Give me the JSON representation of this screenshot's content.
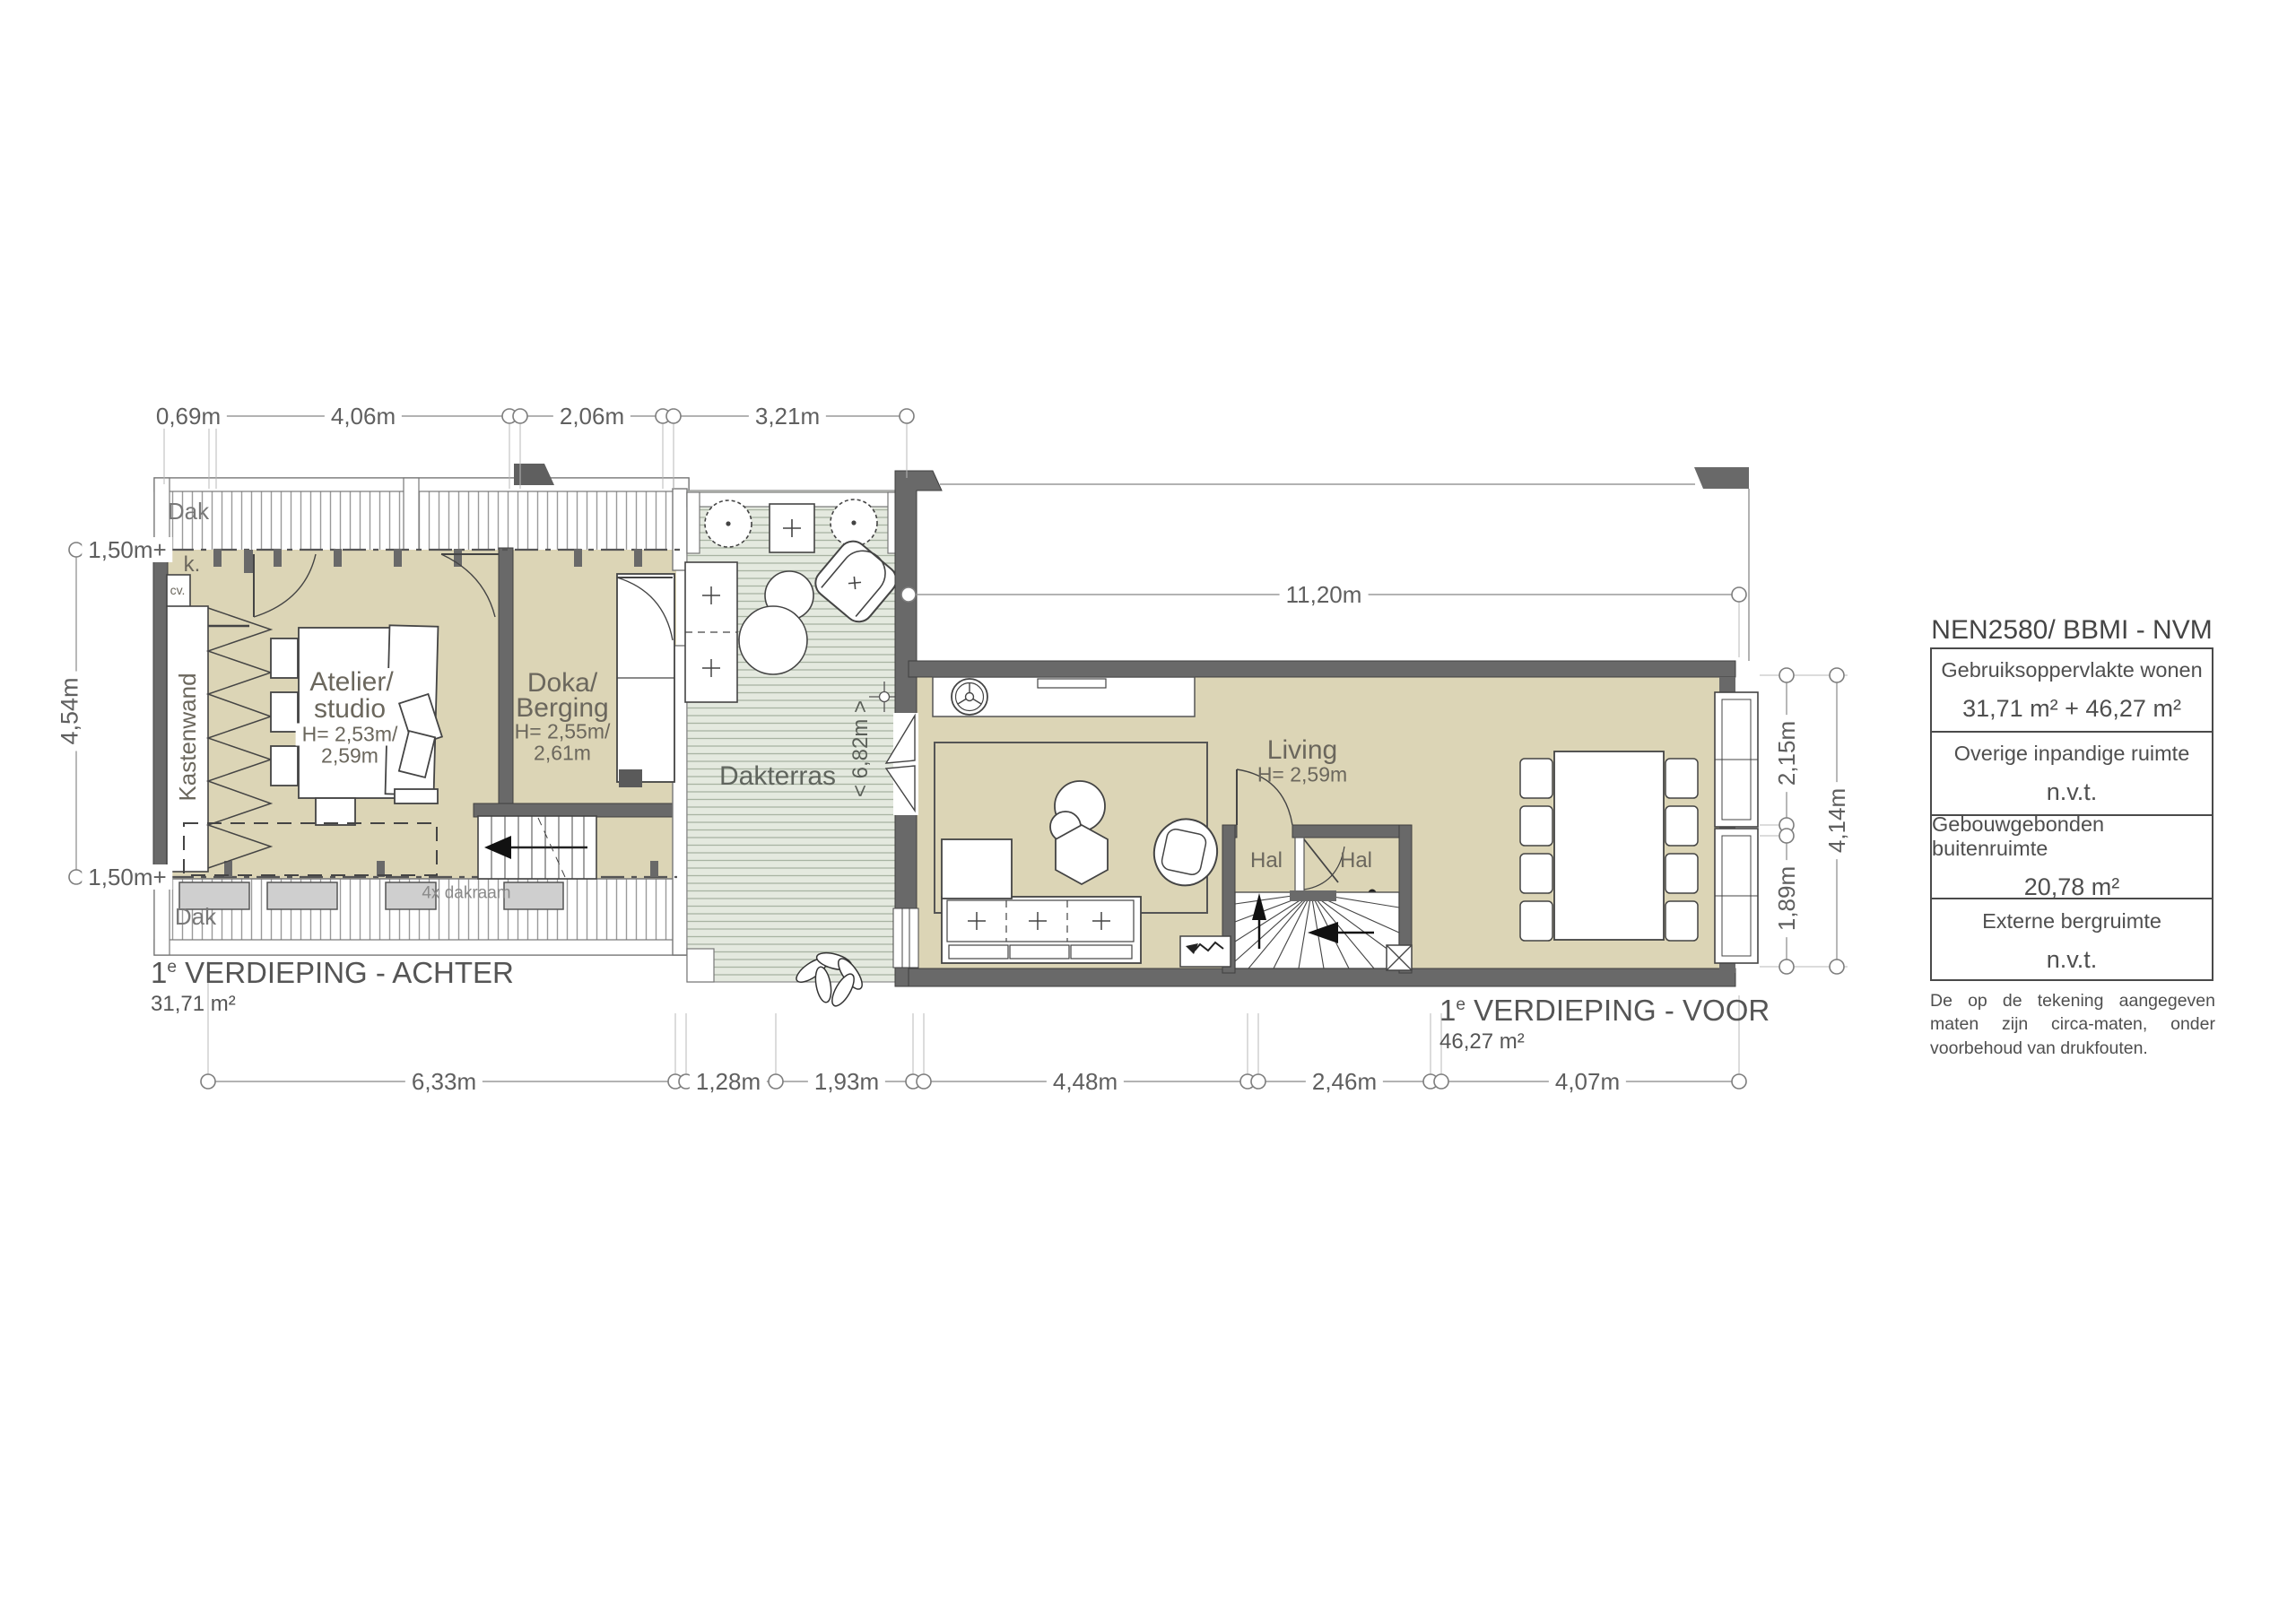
{
  "dims": {
    "top": [
      "0,69m",
      "4,06m",
      "2,06m",
      "3,21m"
    ],
    "span": "11,20m",
    "terrace_width": "< 6,82m >",
    "left_top": "1,50m+",
    "left_height": "4,54m",
    "left_bottom": "1,50m+",
    "right_top": "2,15m",
    "right_bottom": "1,89m",
    "right_total": "4,14m",
    "bottom": [
      "6,33m",
      "1,28m",
      "1,93m",
      "4,48m",
      "2,46m",
      "4,07m"
    ]
  },
  "rooms": {
    "atelier_name_1": "Atelier/",
    "atelier_name_2": "studio",
    "atelier_height_1": "H= 2,53m/",
    "atelier_height_2": "2,59m",
    "doka_name_1": "Doka/",
    "doka_name_2": "Berging",
    "doka_height_1": "H= 2,55m/",
    "doka_height_2": "2,61m",
    "dakterras": "Dakterras",
    "living_name": "Living",
    "living_height": "H= 2,59m",
    "hal_left": "Hal",
    "hal_right": "Hal",
    "kastenwand": "Kastenwand",
    "closet": "k.",
    "cv": "cv.",
    "dak_top": "Dak",
    "dak_bottom": "Dak",
    "dakraam": "4x dakraam"
  },
  "sections": {
    "achter_num": "1",
    "achter_sup": "e",
    "achter_title": " VERDIEPING - ACHTER",
    "achter_area": "31,71 m²",
    "voor_num": "1",
    "voor_sup": "e",
    "voor_title": " VERDIEPING - VOOR",
    "voor_area": "46,27 m²"
  },
  "legend": {
    "title": "NEN2580/ BBMI - NVM",
    "rows": [
      {
        "label": "Gebruiksoppervlakte wonen",
        "value": "31,71 m² + 46,27 m²"
      },
      {
        "label": "Overige inpandige ruimte",
        "value": "n.v.t."
      },
      {
        "label": "Gebouwgebonden buitenruimte",
        "value": "20,78 m²"
      },
      {
        "label": "Externe bergruimte",
        "value": "n.v.t."
      }
    ],
    "disclaimer": "De op de tekening aangegeven maten zijn circa-maten, onder voorbehoud van drukfouten."
  },
  "colors": {
    "room_fill": "#dcd5b6",
    "terrace_fill": "#e4e9df",
    "terrace_line": "#a8b3a2",
    "wall": "#696969",
    "dim_line": "#9a9a9a",
    "text": "#5f5f5f"
  }
}
